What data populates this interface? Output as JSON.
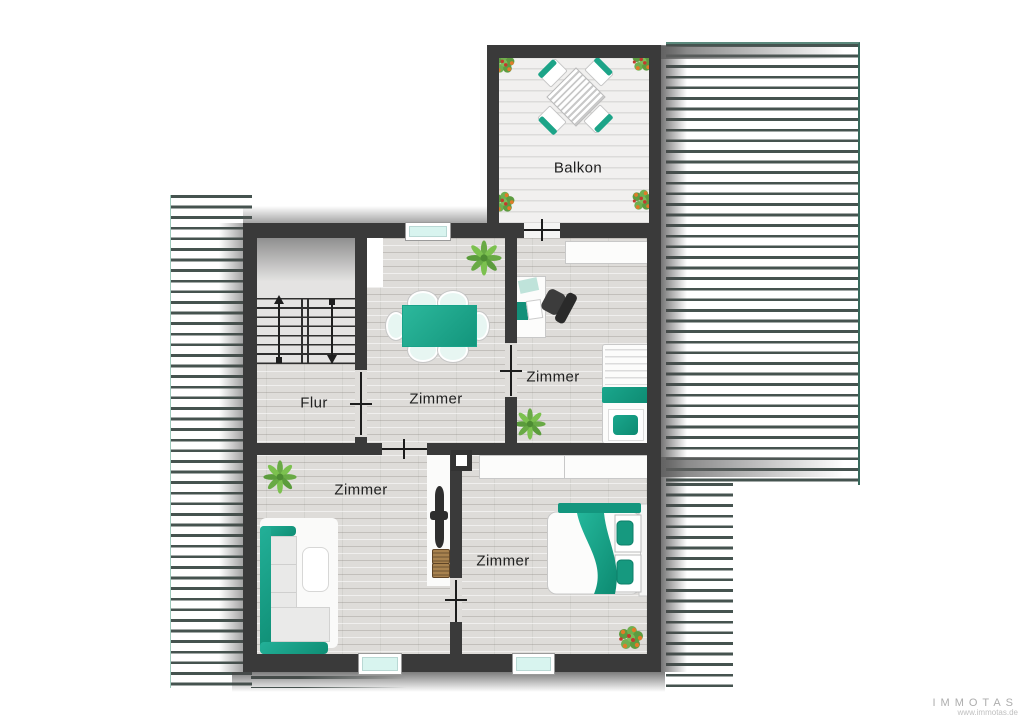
{
  "plan": {
    "rooms": {
      "balkon": {
        "label": "Balkon"
      },
      "flur": {
        "label": "Flur"
      },
      "zimmer_dining": {
        "label": "Zimmer"
      },
      "zimmer_office": {
        "label": "Zimmer"
      },
      "zimmer_living": {
        "label": "Zimmer"
      },
      "zimmer_bedroom": {
        "label": "Zimmer"
      }
    },
    "features": {
      "windows": 3,
      "doors": 5,
      "stairs": "double-run with up and down arrows"
    }
  },
  "branding": {
    "company": "IMMOTAS",
    "website": "www.immotas.de"
  },
  "colors": {
    "accent_teal": "#17a189",
    "wall": "#3a3a3a",
    "floor": "#dedcd9",
    "balcony_deck": "#f1f0ef",
    "hatch_line": "#45534f",
    "window_glass": "#d8f4ef",
    "logo_gray": "#adadad"
  },
  "icons": {
    "palm-plant-icon": "green starburst leaves",
    "flower-pot-icon": "green cluster with orange-red blooms",
    "stairs-up-arrow-icon": "line with triangle up",
    "stairs-down-arrow-icon": "line with triangle down",
    "door-icon": "threshold line with cross tick",
    "chimney-icon": "white square with thick dark border"
  }
}
